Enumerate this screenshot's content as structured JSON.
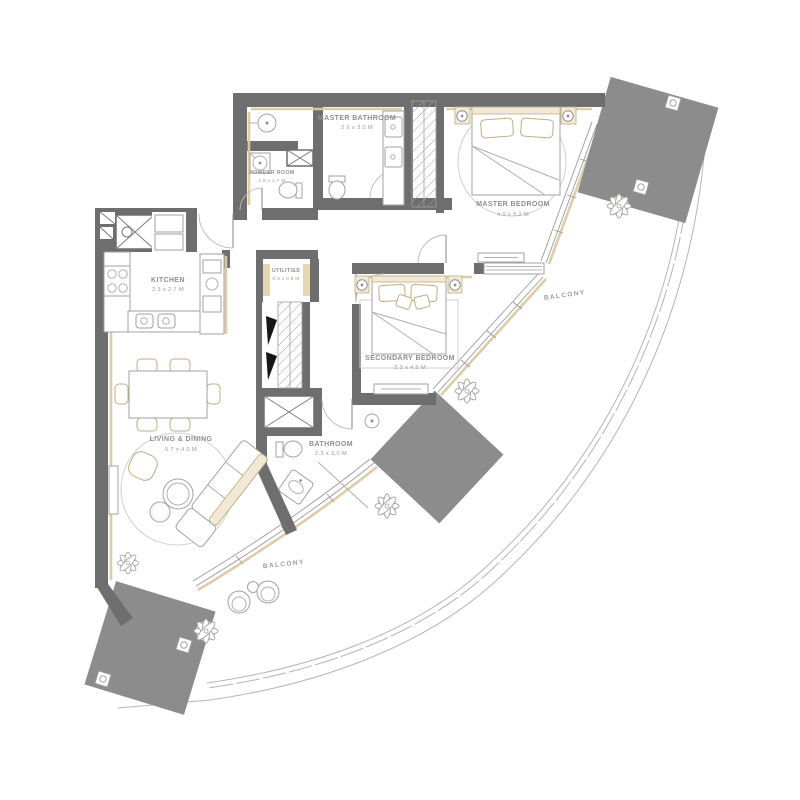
{
  "rooms": {
    "master_bathroom": {
      "name": "MASTER BATHROOM",
      "dims": "2.6 x 3.0 M"
    },
    "powder_room": {
      "name": "POWDER ROOM",
      "dims": "1.5 x 1.7 M"
    },
    "kitchen": {
      "name": "KITCHEN",
      "dims": "2.3 x 2.7 M"
    },
    "utilities": {
      "name": "UTILITIES",
      "dims": "0.9 x 0.8 M"
    },
    "master_bedroom": {
      "name": "MASTER BEDROOM",
      "dims": "4.0 x 5.2 M"
    },
    "secondary_bedroom": {
      "name": "SECONDARY BEDROOM",
      "dims": "3.3 x 4.5 M"
    },
    "bathroom": {
      "name": "BATHROOM",
      "dims": "2.3 x 3.0 M"
    },
    "living_dining": {
      "name": "LIVING & DINING",
      "dims": "5.7 x 4.0 M"
    },
    "balcony_right": {
      "name": "BALCONY"
    },
    "balcony_bottom": {
      "name": "BALCONY"
    }
  },
  "colors": {
    "wall": "#6e6e6e",
    "structural_block": "#8c8c8c",
    "accent_beige": "#dbc9a2",
    "outline_gray": "#a2a2a2",
    "label_text": "#8e8e8e",
    "background": "#ffffff"
  }
}
